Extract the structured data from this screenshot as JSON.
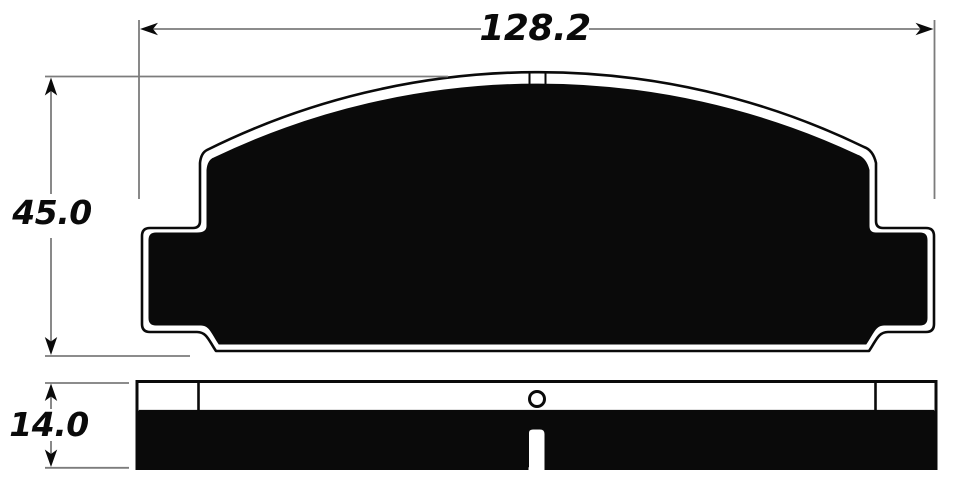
{
  "drawing": {
    "dimensions": {
      "width": "128.2",
      "height": "45.0",
      "thickness": "14.0"
    },
    "colors": {
      "background": "#ffffff",
      "ink": "#0a0a0a",
      "dim_line": "#7c7c7c"
    }
  }
}
